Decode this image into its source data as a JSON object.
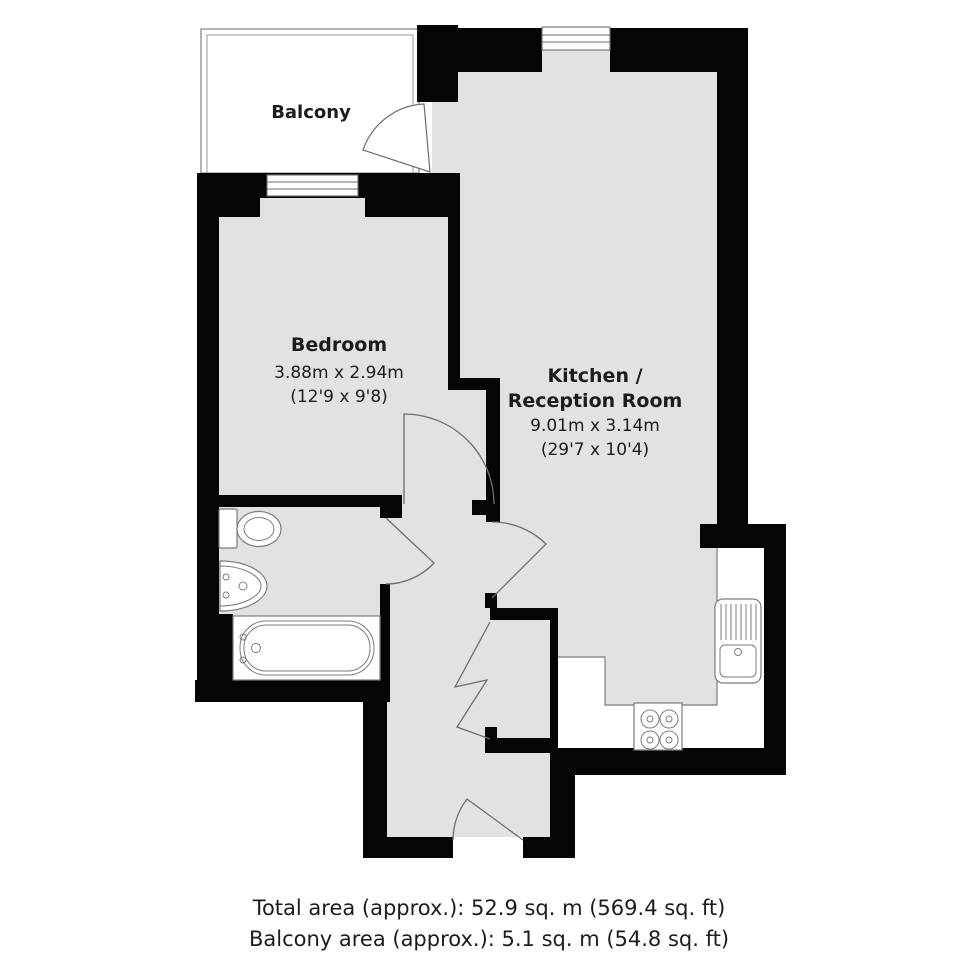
{
  "plan": {
    "balcony": {
      "label": "Balcony"
    },
    "bedroom": {
      "label": "Bedroom",
      "metric": "3.88m x 2.94m",
      "imperial": "(12'9 x 9'8)"
    },
    "kitchen": {
      "label_line1": "Kitchen /",
      "label_line2": "Reception Room",
      "metric": "9.01m x 3.14m",
      "imperial": "(29'7 x 10'4)"
    }
  },
  "footer": {
    "total_area": "Total area (approx.): 52.9 sq. m (569.4 sq. ft)",
    "balcony_area": "Balcony area (approx.): 5.1 sq. m (54.8 sq. ft)"
  },
  "fixtures": [
    "toilet",
    "wash-basin",
    "bathtub",
    "kitchen-sink-drainer",
    "hob",
    "worktop",
    "bedroom-window",
    "kitchen-window",
    "balcony-door",
    "bedroom-door",
    "kitchen-door",
    "bathroom-door",
    "entrance-door",
    "closet-folding-door"
  ],
  "colors": {
    "wall": "#050505",
    "floor": "#e2e2e2",
    "outline": "#7d7d7d",
    "door": "#6e6e6e",
    "text": "#1c1c1c"
  }
}
